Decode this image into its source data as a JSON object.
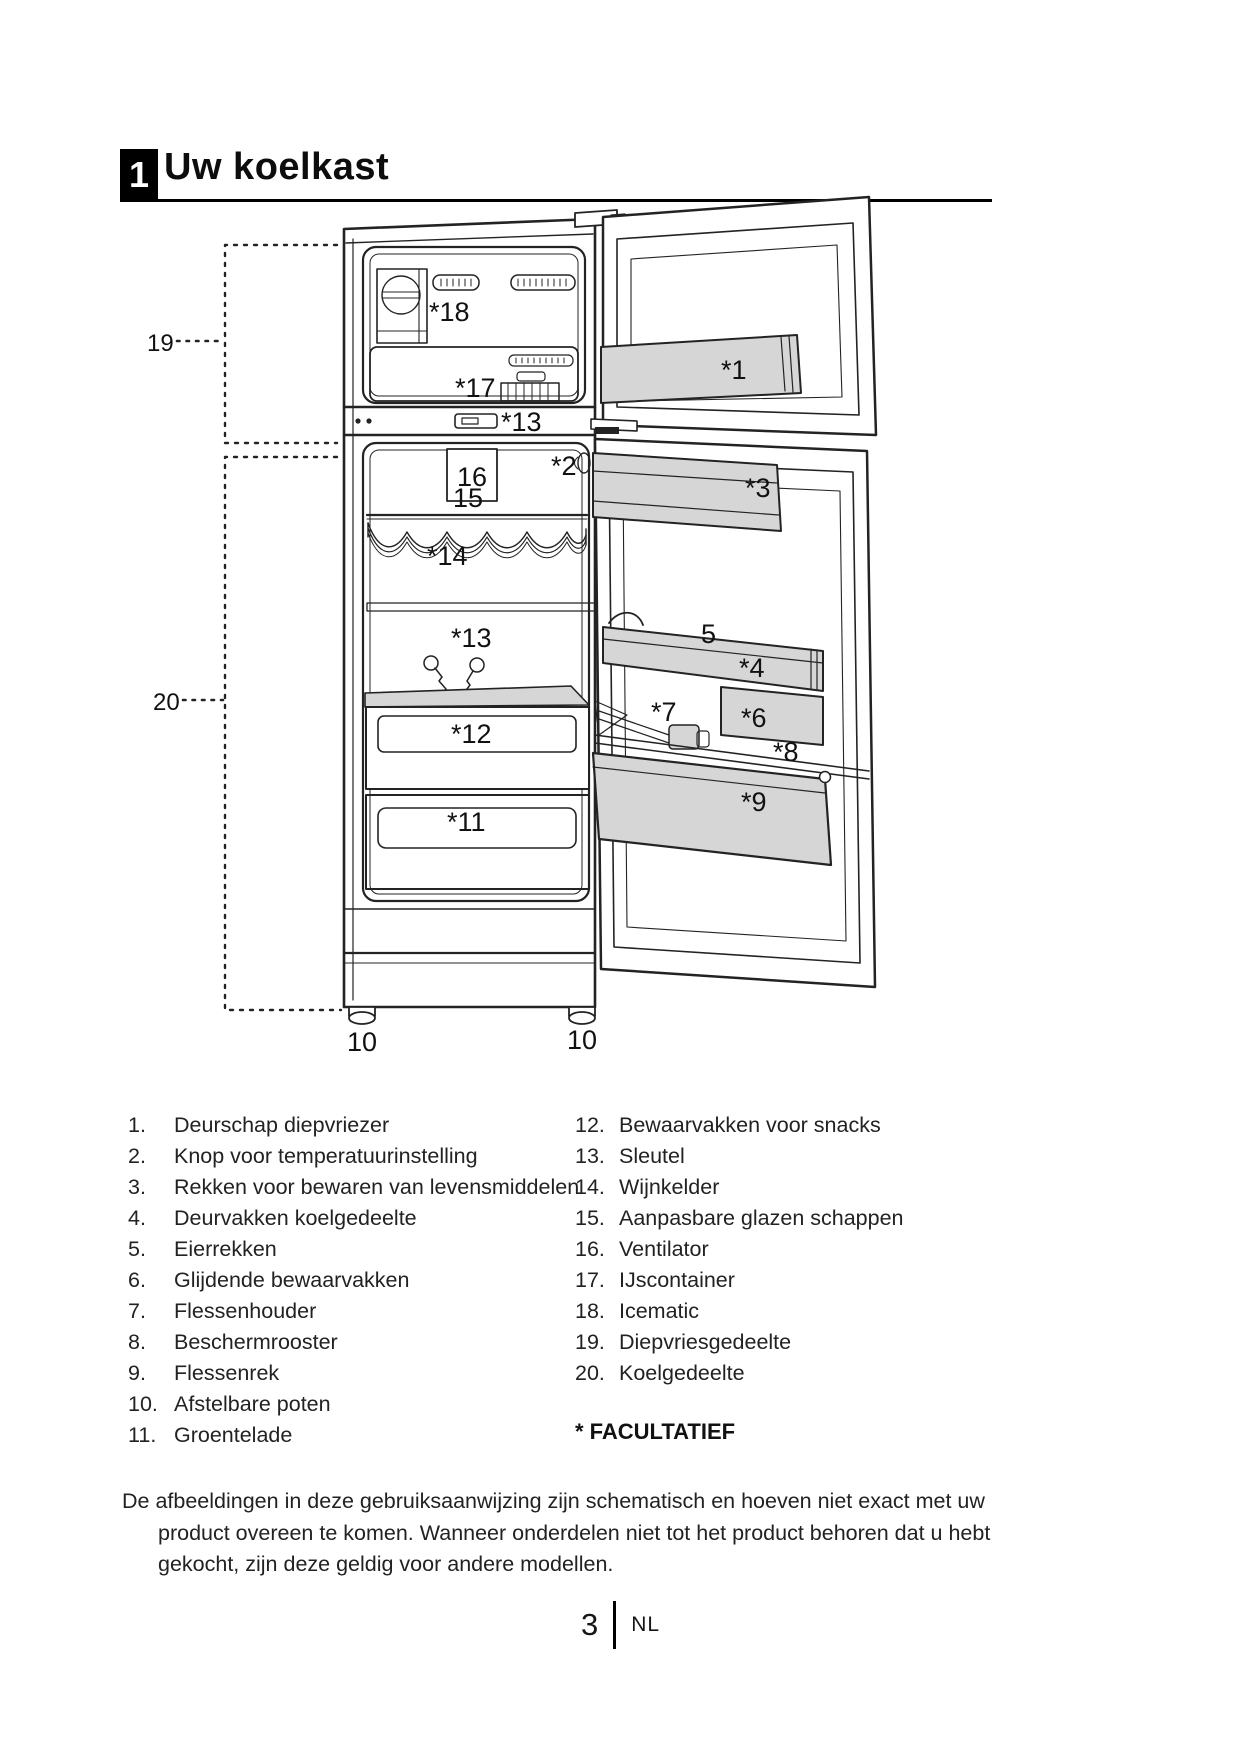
{
  "header": {
    "section_number": "1",
    "title": "Uw koelkast"
  },
  "diagram": {
    "callouts": {
      "freezer_zone": "19",
      "fridge_zone": "20",
      "icematic": "*18",
      "ice_container": "*17",
      "key_top": "*13",
      "ventilator": "16",
      "glass_shelves": "15",
      "wine_cellar": "*14",
      "temp_knob": "*2",
      "door_racks": "*3",
      "freezer_door_shelf": "*1",
      "egg_rack": "5",
      "fridge_door_shelf": "*4",
      "sliding_compartment": "*6",
      "bottle_holder": "*7",
      "protection_grille": "*8",
      "bottle_rack": "*9",
      "key_mid": "*13",
      "snack_compartment": "*12",
      "crisper": "*11",
      "foot_left": "10",
      "foot_right": "10"
    }
  },
  "parts_list": {
    "left": [
      {
        "num": "1.",
        "label": "Deurschap diepvriezer"
      },
      {
        "num": "2.",
        "label": "Knop voor temperatuurinstelling"
      },
      {
        "num": "3.",
        "label": "Rekken voor bewaren van levensmiddelen"
      },
      {
        "num": "4.",
        "label": "Deurvakken koelgedeelte"
      },
      {
        "num": "5.",
        "label": "Eierrekken"
      },
      {
        "num": "6.",
        "label": "Glijdende bewaarvakken"
      },
      {
        "num": "7.",
        "label": "Flessenhouder"
      },
      {
        "num": "8.",
        "label": "Beschermrooster"
      },
      {
        "num": "9.",
        "label": "Flessenrek"
      },
      {
        "num": "10.",
        "label": "Afstelbare poten"
      },
      {
        "num": "11.",
        "label": "Groentelade"
      }
    ],
    "right": [
      {
        "num": "12.",
        "label": "Bewaarvakken voor snacks"
      },
      {
        "num": "13.",
        "label": "Sleutel"
      },
      {
        "num": "14.",
        "label": "Wijnkelder"
      },
      {
        "num": "15.",
        "label": "Aanpasbare glazen schappen"
      },
      {
        "num": "16.",
        "label": "Ventilator"
      },
      {
        "num": "17.",
        "label": "IJscontainer"
      },
      {
        "num": "18.",
        "label": "Icematic"
      },
      {
        "num": "19.",
        "label": "Diepvriesgedeelte"
      },
      {
        "num": "20.",
        "label": "Koelgedeelte"
      }
    ],
    "footnote": "* FACULTATIEF"
  },
  "note": {
    "lines": [
      "De afbeeldingen in deze gebruiksaanwijzing zijn schematisch en hoeven niet exact met uw",
      "product overeen te komen. Wanneer onderdelen niet tot het product behoren dat u hebt",
      "gekocht, zijn deze geldig voor andere modellen."
    ]
  },
  "footer": {
    "page_number": "3",
    "language": "NL"
  }
}
